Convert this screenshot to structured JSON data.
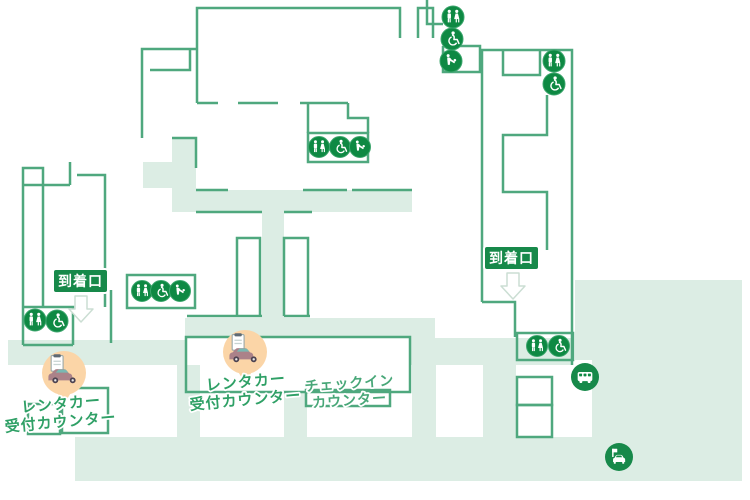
{
  "map": {
    "kind": "airport-terminal-floor-plan",
    "labels": {
      "arrival_gate": "到着口",
      "rental_line1": "レンタカー",
      "rental_line2": "受付カウンター",
      "checkin_line1": "チェックイン",
      "checkin_line2": "カウンター"
    },
    "facility_groups": [
      {
        "id": "top-right-column",
        "icons": [
          "restroom",
          "wheelchair-accessible",
          "nursing-room"
        ]
      },
      {
        "id": "center-upper-box",
        "icons": [
          "restroom",
          "wheelchair-accessible",
          "nursing-room"
        ]
      },
      {
        "id": "right-tower-upper",
        "icons": [
          "restroom",
          "wheelchair-accessible"
        ]
      },
      {
        "id": "right-tower-lower",
        "icons": [
          "restroom",
          "wheelchair-accessible"
        ]
      },
      {
        "id": "left-mid-box",
        "icons": [
          "restroom",
          "wheelchair-accessible",
          "nursing-room"
        ]
      },
      {
        "id": "left-lower-box",
        "icons": [
          "restroom",
          "wheelchair-accessible"
        ]
      }
    ],
    "transport_markers": [
      {
        "id": "bus-stop",
        "icon": "bus"
      },
      {
        "id": "taxi-stand",
        "icon": "taxi"
      }
    ],
    "poi_markers": [
      {
        "id": "rental-car-counter-left",
        "icon": "rental-car"
      },
      {
        "id": "rental-car-counter-center",
        "icon": "rental-car"
      }
    ],
    "colors": {
      "wall_stroke": "#4FA87E",
      "corridor_fill": "#DCEDE4",
      "facility_icon_fill": "#0E8943",
      "gate_label_fill": "#17894A",
      "rental_text": "#2FA066",
      "checkin_text": "#48A778",
      "marker_bubble_fill": "#FBD5A7"
    }
  }
}
